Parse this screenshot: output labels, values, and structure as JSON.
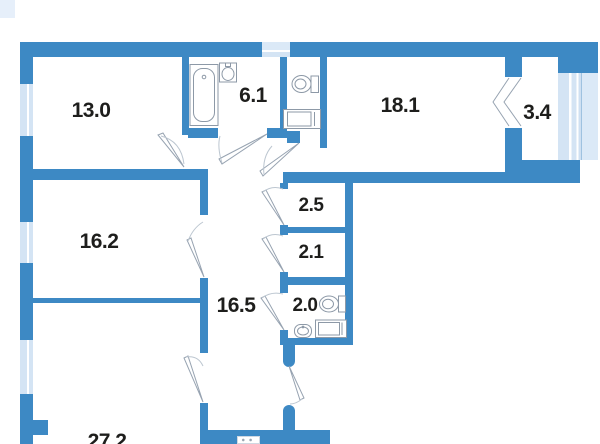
{
  "plan": {
    "rooms": [
      {
        "id": "room-13-0",
        "area": "13.0"
      },
      {
        "id": "bathroom-6-1",
        "area": "6.1"
      },
      {
        "id": "room-18-1",
        "area": "18.1"
      },
      {
        "id": "balcony-3-4",
        "area": "3.4"
      },
      {
        "id": "room-16-2",
        "area": "16.2"
      },
      {
        "id": "hallway-16-5",
        "area": "16.5"
      },
      {
        "id": "storage-2-5",
        "area": "2.5"
      },
      {
        "id": "storage-2-1",
        "area": "2.1"
      },
      {
        "id": "wc-2-0",
        "area": "2.0"
      },
      {
        "id": "room-27-2",
        "area": "27.2"
      }
    ],
    "colors": {
      "wall": "#3d89c4",
      "window": "#d4e4f4",
      "vent": "#dbe9f7",
      "label": "#1e1e1c",
      "fixture_outline": "#8d99a7"
    },
    "icons": {
      "bathtub": "rounded-rect-tub",
      "sink": "bowl-with-tap",
      "toilet": "oval-with-tank",
      "washing_machine": "double-rect",
      "door_swing": "wedge-arc",
      "folding_door": "chevrons"
    }
  }
}
